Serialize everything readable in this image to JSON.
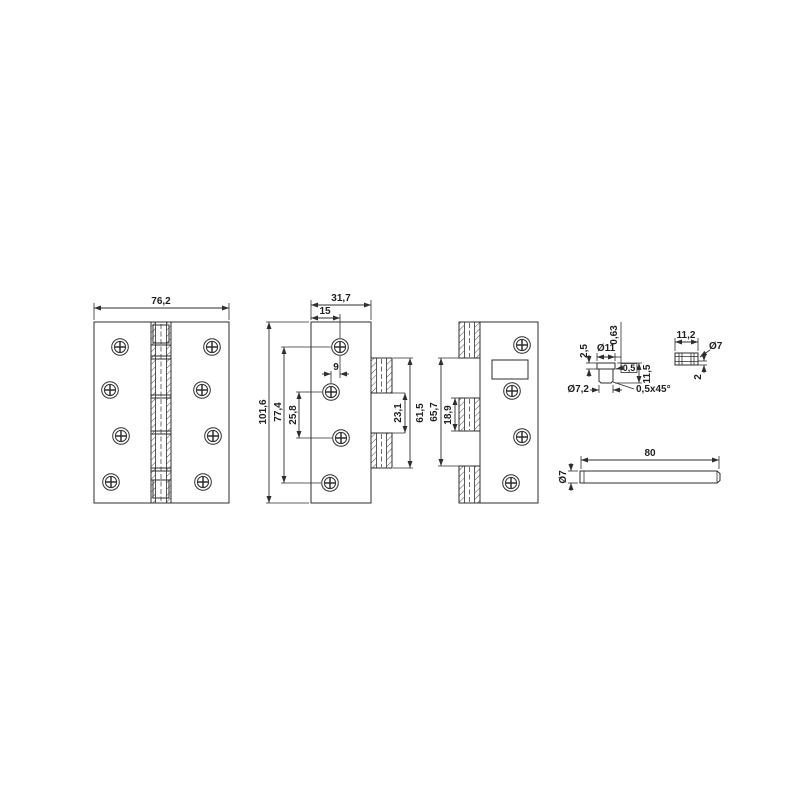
{
  "meta": {
    "description": "Technical dimension drawing of a four-knuckle door hinge with pin and bushing details"
  },
  "colors": {
    "background": "#ffffff",
    "line": "#2e2e2e",
    "text": "#1f1f1f"
  },
  "front_view": {
    "width": "76,2"
  },
  "leaf_a": {
    "width": "31,7",
    "hole_inset": "15",
    "height": "101,6",
    "hole_span": "77,4",
    "hole_pitch": "25,8",
    "hole_stagger": "9",
    "knuckle_gap": "23,1",
    "knuckle_span": "61,5"
  },
  "leaf_b": {
    "knuckle_span": "65,7",
    "center_knuckle": "18,9"
  },
  "bushing": {
    "cap_height": "2,5",
    "cap_diameter": "Ø11",
    "clearance": "0,63",
    "step": "0,5",
    "height": "11,5",
    "shank_diameter": "Ø7,2",
    "chamfer": "0,5x45°"
  },
  "sleeve": {
    "length": "11,2",
    "diameter": "Ø7",
    "wall": "2"
  },
  "pin": {
    "length": "80",
    "diameter": "Ø7"
  }
}
